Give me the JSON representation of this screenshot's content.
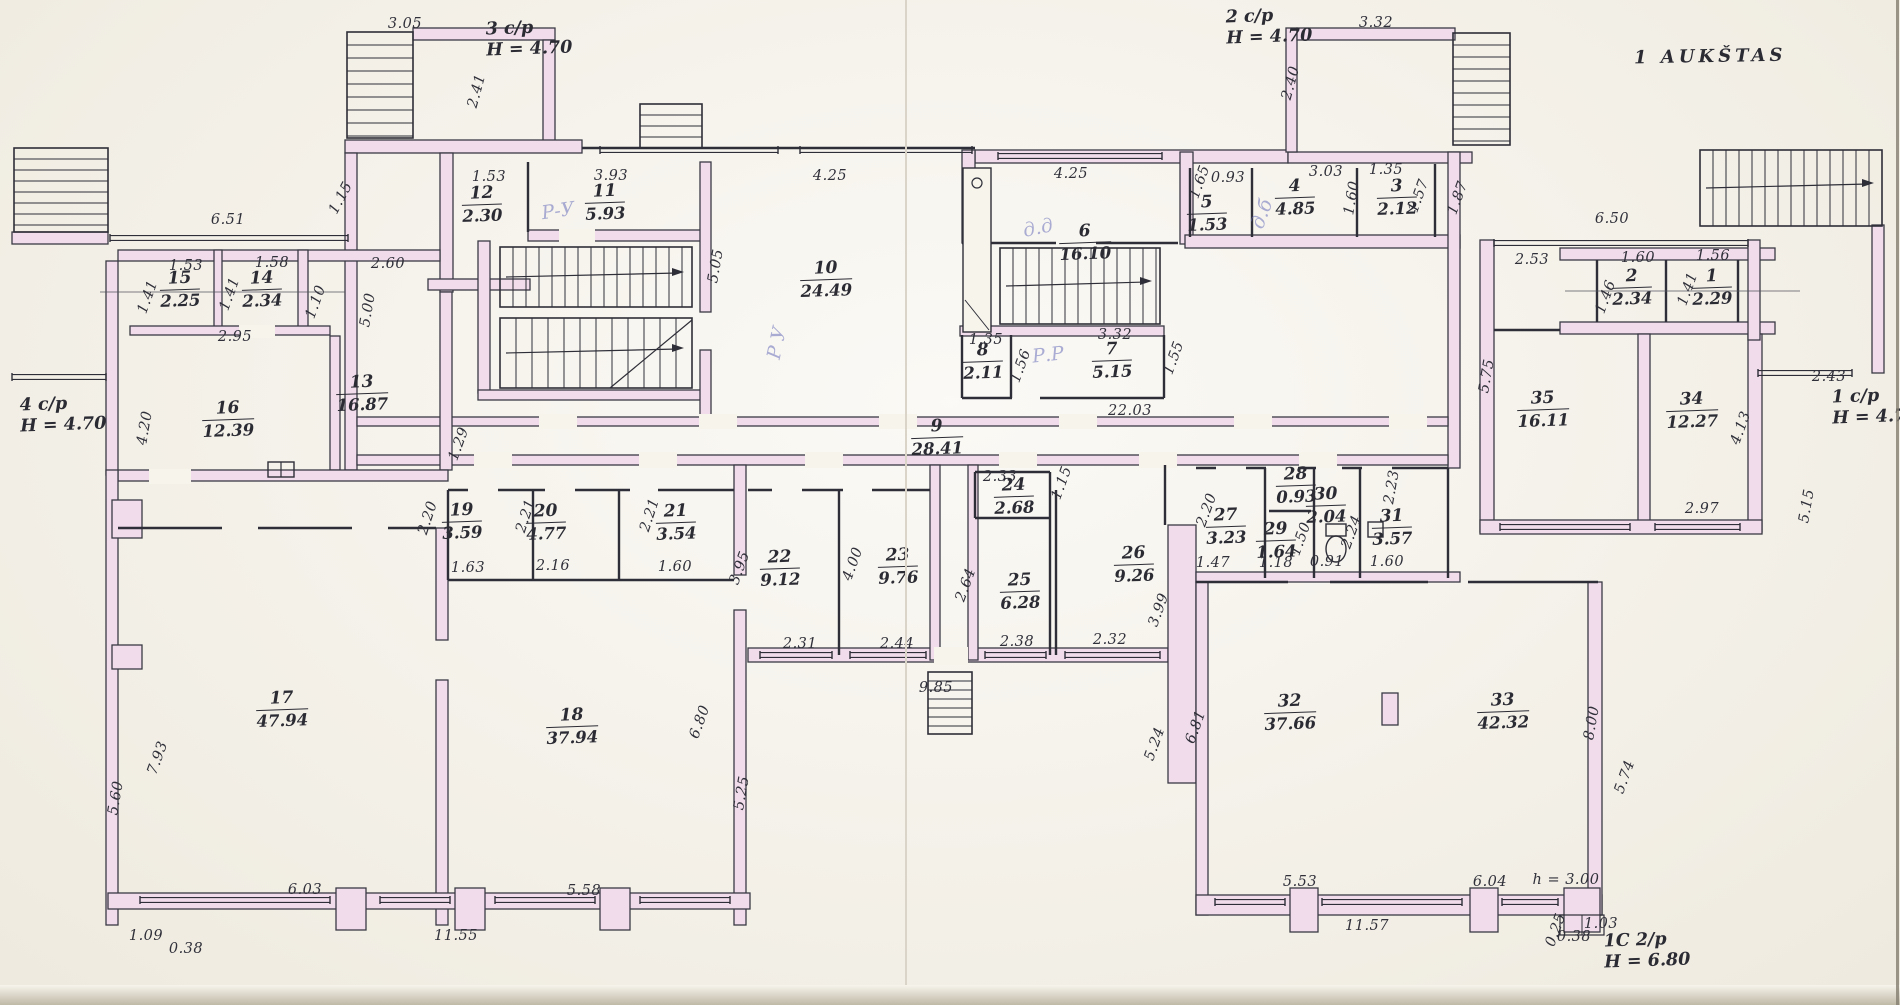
{
  "title": "1 AUKŠTAS",
  "colors": {
    "paper": "#f7f4ec",
    "ink": "#2e2e38",
    "wall_fill": "#f0dcea",
    "pencil": "#8890c8"
  },
  "stair_labels": [
    {
      "name": "3 c/p",
      "height": "H = 4.70",
      "x": 486,
      "y": 18
    },
    {
      "name": "2 c/p",
      "height": "H = 4.70",
      "x": 1226,
      "y": 6
    },
    {
      "name": "4 c/p",
      "height": "H = 4.70",
      "x": 20,
      "y": 394
    },
    {
      "name": "1 c/p",
      "height": "H = 4.70",
      "x": 1832,
      "y": 386
    },
    {
      "name": "1C 2/p",
      "height": "H = 6.80",
      "x": 1604,
      "y": 930
    }
  ],
  "rooms": [
    {
      "n": "1",
      "a": "2.29",
      "x": 1712,
      "y": 288
    },
    {
      "n": "2",
      "a": "2.34",
      "x": 1632,
      "y": 288
    },
    {
      "n": "3",
      "a": "2.12",
      "x": 1397,
      "y": 198
    },
    {
      "n": "4",
      "a": "4.85",
      "x": 1295,
      "y": 198
    },
    {
      "n": "5",
      "a": "1.53",
      "x": 1207,
      "y": 214
    },
    {
      "n": "6",
      "a": "16.10",
      "x": 1085,
      "y": 243
    },
    {
      "n": "7",
      "a": "5.15",
      "x": 1112,
      "y": 361
    },
    {
      "n": "8",
      "a": "2.11",
      "x": 983,
      "y": 362
    },
    {
      "n": "9",
      "a": "28.41",
      "x": 937,
      "y": 438
    },
    {
      "n": "10",
      "a": "24.49",
      "x": 826,
      "y": 280
    },
    {
      "n": "11",
      "a": "5.93",
      "x": 605,
      "y": 203
    },
    {
      "n": "12",
      "a": "2.30",
      "x": 482,
      "y": 205
    },
    {
      "n": "13",
      "a": "16.87",
      "x": 362,
      "y": 394
    },
    {
      "n": "14",
      "a": "2.34",
      "x": 262,
      "y": 290
    },
    {
      "n": "15",
      "a": "2.25",
      "x": 180,
      "y": 290
    },
    {
      "n": "16",
      "a": "12.39",
      "x": 228,
      "y": 420
    },
    {
      "n": "17",
      "a": "47.94",
      "x": 282,
      "y": 710
    },
    {
      "n": "18",
      "a": "37.94",
      "x": 572,
      "y": 727
    },
    {
      "n": "19",
      "a": "3.59",
      "x": 462,
      "y": 522
    },
    {
      "n": "20",
      "a": "4.77",
      "x": 546,
      "y": 523
    },
    {
      "n": "21",
      "a": "3.54",
      "x": 676,
      "y": 523
    },
    {
      "n": "22",
      "a": "9.12",
      "x": 780,
      "y": 569
    },
    {
      "n": "23",
      "a": "9.76",
      "x": 898,
      "y": 567
    },
    {
      "n": "24",
      "a": "2.68",
      "x": 1014,
      "y": 497
    },
    {
      "n": "25",
      "a": "6.28",
      "x": 1020,
      "y": 592
    },
    {
      "n": "26",
      "a": "9.26",
      "x": 1134,
      "y": 565
    },
    {
      "n": "27",
      "a": "3.23",
      "x": 1226,
      "y": 527
    },
    {
      "n": "28",
      "a": "0.93",
      "x": 1296,
      "y": 486
    },
    {
      "n": "29",
      "a": "1.64",
      "x": 1276,
      "y": 541
    },
    {
      "n": "30",
      "a": "2.04",
      "x": 1326,
      "y": 506
    },
    {
      "n": "31",
      "a": "3.57",
      "x": 1392,
      "y": 528
    },
    {
      "n": "32",
      "a": "37.66",
      "x": 1290,
      "y": 713
    },
    {
      "n": "33",
      "a": "42.32",
      "x": 1503,
      "y": 712
    },
    {
      "n": "34",
      "a": "12.27",
      "x": 1692,
      "y": 411
    },
    {
      "n": "35",
      "a": "16.11",
      "x": 1543,
      "y": 410
    }
  ],
  "dimensions": [
    {
      "t": "3.05",
      "x": 405,
      "y": 24,
      "r": 0
    },
    {
      "t": "2.41",
      "x": 477,
      "y": 91,
      "r": -75
    },
    {
      "t": "1.15",
      "x": 341,
      "y": 198,
      "r": -62
    },
    {
      "t": "6.51",
      "x": 228,
      "y": 220,
      "r": 0
    },
    {
      "t": "1.53",
      "x": 489,
      "y": 177,
      "r": 0
    },
    {
      "t": "3.93",
      "x": 611,
      "y": 176,
      "r": 0
    },
    {
      "t": "4.25",
      "x": 830,
      "y": 176,
      "r": 0
    },
    {
      "t": "4.25",
      "x": 1071,
      "y": 174,
      "r": 0
    },
    {
      "t": "5.05",
      "x": 716,
      "y": 266,
      "r": -80
    },
    {
      "t": "1.65",
      "x": 1200,
      "y": 182,
      "r": -70
    },
    {
      "t": "0.93",
      "x": 1228,
      "y": 178,
      "r": 0
    },
    {
      "t": "3.03",
      "x": 1326,
      "y": 172,
      "r": 0
    },
    {
      "t": "1.60",
      "x": 1352,
      "y": 198,
      "r": -80
    },
    {
      "t": "1.35",
      "x": 1386,
      "y": 170,
      "r": 0
    },
    {
      "t": "1.57",
      "x": 1419,
      "y": 196,
      "r": -70
    },
    {
      "t": "1.87",
      "x": 1458,
      "y": 198,
      "r": -70
    },
    {
      "t": "2.40",
      "x": 1291,
      "y": 83,
      "r": -75
    },
    {
      "t": "3.32",
      "x": 1376,
      "y": 23,
      "r": 0
    },
    {
      "t": "6.50",
      "x": 1612,
      "y": 219,
      "r": 0
    },
    {
      "t": "2.53",
      "x": 1532,
      "y": 260,
      "r": 0
    },
    {
      "t": "1.60",
      "x": 1638,
      "y": 258,
      "r": 0
    },
    {
      "t": "1.56",
      "x": 1713,
      "y": 256,
      "r": 0
    },
    {
      "t": "1.46",
      "x": 1606,
      "y": 297,
      "r": -70
    },
    {
      "t": "1.41",
      "x": 1688,
      "y": 289,
      "r": -70
    },
    {
      "t": "2.43",
      "x": 1829,
      "y": 377,
      "r": 0
    },
    {
      "t": "5.75",
      "x": 1487,
      "y": 376,
      "r": -80
    },
    {
      "t": "4.13",
      "x": 1741,
      "y": 428,
      "r": -70
    },
    {
      "t": "2.97",
      "x": 1702,
      "y": 509,
      "r": 0
    },
    {
      "t": "5.15",
      "x": 1807,
      "y": 506,
      "r": -80
    },
    {
      "t": "1.53",
      "x": 186,
      "y": 266,
      "r": 0
    },
    {
      "t": "1.58",
      "x": 272,
      "y": 263,
      "r": 0
    },
    {
      "t": "2.60",
      "x": 388,
      "y": 264,
      "r": 0
    },
    {
      "t": "1.41",
      "x": 148,
      "y": 297,
      "r": -70
    },
    {
      "t": "1.41",
      "x": 230,
      "y": 294,
      "r": -70
    },
    {
      "t": "1.10",
      "x": 316,
      "y": 302,
      "r": -70
    },
    {
      "t": "2.95",
      "x": 235,
      "y": 337,
      "r": 0
    },
    {
      "t": "4.20",
      "x": 145,
      "y": 428,
      "r": -80
    },
    {
      "t": "5.00",
      "x": 368,
      "y": 310,
      "r": -80
    },
    {
      "t": "1.29",
      "x": 459,
      "y": 444,
      "r": -70
    },
    {
      "t": "1.35",
      "x": 986,
      "y": 340,
      "r": 0
    },
    {
      "t": "1.56",
      "x": 1021,
      "y": 366,
      "r": -70
    },
    {
      "t": "3.32",
      "x": 1115,
      "y": 335,
      "r": 0
    },
    {
      "t": "1.55",
      "x": 1174,
      "y": 358,
      "r": -70
    },
    {
      "t": "22.03",
      "x": 1130,
      "y": 411,
      "r": 0
    },
    {
      "t": "2.33",
      "x": 1000,
      "y": 477,
      "r": 0
    },
    {
      "t": "1.15",
      "x": 1062,
      "y": 483,
      "r": -70
    },
    {
      "t": "2.20",
      "x": 428,
      "y": 518,
      "r": -72
    },
    {
      "t": "2.21",
      "x": 526,
      "y": 516,
      "r": -72
    },
    {
      "t": "2.21",
      "x": 650,
      "y": 515,
      "r": -72
    },
    {
      "t": "1.63",
      "x": 468,
      "y": 568,
      "r": 0
    },
    {
      "t": "2.16",
      "x": 553,
      "y": 566,
      "r": 0
    },
    {
      "t": "1.60",
      "x": 675,
      "y": 567,
      "r": 0
    },
    {
      "t": "3.95",
      "x": 740,
      "y": 568,
      "r": -70
    },
    {
      "t": "4.00",
      "x": 853,
      "y": 564,
      "r": -70
    },
    {
      "t": "2.64",
      "x": 966,
      "y": 585,
      "r": -70
    },
    {
      "t": "2.31",
      "x": 800,
      "y": 644,
      "r": 0
    },
    {
      "t": "2.44",
      "x": 897,
      "y": 644,
      "r": 0
    },
    {
      "t": "2.38",
      "x": 1017,
      "y": 642,
      "r": 0
    },
    {
      "t": "2.32",
      "x": 1110,
      "y": 640,
      "r": 0
    },
    {
      "t": "9.85",
      "x": 936,
      "y": 688,
      "r": 0
    },
    {
      "t": "3.99",
      "x": 1159,
      "y": 610,
      "r": -70
    },
    {
      "t": "5.24",
      "x": 1155,
      "y": 744,
      "r": -70
    },
    {
      "t": "6.81",
      "x": 1196,
      "y": 727,
      "r": -70
    },
    {
      "t": "2.20",
      "x": 1207,
      "y": 510,
      "r": -70
    },
    {
      "t": "1.47",
      "x": 1213,
      "y": 563,
      "r": 0
    },
    {
      "t": "1.18",
      "x": 1276,
      "y": 563,
      "r": 0
    },
    {
      "t": "0.91",
      "x": 1327,
      "y": 562,
      "r": 0
    },
    {
      "t": "1.60",
      "x": 1387,
      "y": 562,
      "r": 0
    },
    {
      "t": "1.50",
      "x": 1301,
      "y": 539,
      "r": -70
    },
    {
      "t": "2.24",
      "x": 1352,
      "y": 532,
      "r": -70
    },
    {
      "t": "2.23",
      "x": 1392,
      "y": 487,
      "r": -80
    },
    {
      "t": "5.60",
      "x": 116,
      "y": 798,
      "r": -80
    },
    {
      "t": "7.93",
      "x": 158,
      "y": 758,
      "r": -70
    },
    {
      "t": "6.03",
      "x": 305,
      "y": 890,
      "r": 0
    },
    {
      "t": "1.09",
      "x": 146,
      "y": 936,
      "r": 0
    },
    {
      "t": "0.38",
      "x": 186,
      "y": 949,
      "r": 0
    },
    {
      "t": "11.55",
      "x": 456,
      "y": 936,
      "r": 0
    },
    {
      "t": "5.58",
      "x": 584,
      "y": 891,
      "r": 0
    },
    {
      "t": "6.80",
      "x": 700,
      "y": 722,
      "r": -70
    },
    {
      "t": "5.25",
      "x": 742,
      "y": 793,
      "r": -80
    },
    {
      "t": "5.53",
      "x": 1300,
      "y": 882,
      "r": 0
    },
    {
      "t": "11.57",
      "x": 1367,
      "y": 926,
      "r": 0
    },
    {
      "t": "6.04",
      "x": 1490,
      "y": 882,
      "r": 0
    },
    {
      "t": "h = 3.00",
      "x": 1566,
      "y": 880,
      "r": 0
    },
    {
      "t": "1.03",
      "x": 1601,
      "y": 924,
      "r": 0
    },
    {
      "t": "0.38",
      "x": 1574,
      "y": 937,
      "r": 0
    },
    {
      "t": "0.25",
      "x": 1556,
      "y": 930,
      "r": -70
    },
    {
      "t": "8.00",
      "x": 1592,
      "y": 723,
      "r": -80
    },
    {
      "t": "5.74",
      "x": 1625,
      "y": 777,
      "r": -70
    }
  ],
  "pencil_notes": [
    {
      "t": "Р-У",
      "x": 558,
      "y": 211,
      "r": -8
    },
    {
      "t": "Р У",
      "x": 777,
      "y": 343,
      "r": -78
    },
    {
      "t": "д.д",
      "x": 1038,
      "y": 228,
      "r": -12
    },
    {
      "t": "Р.Р",
      "x": 1048,
      "y": 355,
      "r": -6
    },
    {
      "t": "д.б",
      "x": 1262,
      "y": 214,
      "r": -70
    }
  ]
}
